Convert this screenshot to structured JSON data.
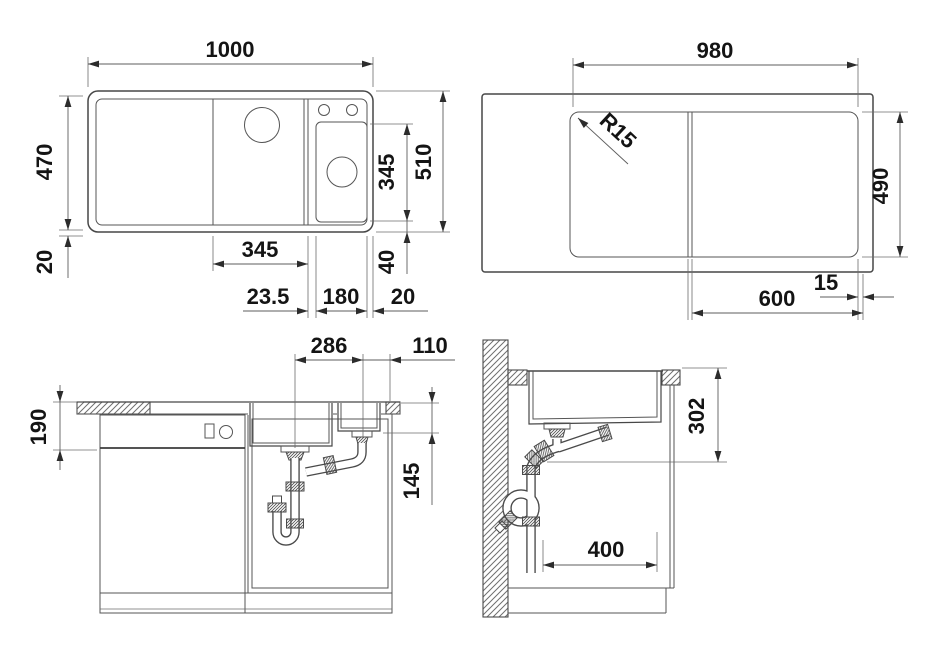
{
  "drawing_type": "sink installation technical drawing",
  "colors": {
    "line": "#4a4a4a",
    "text": "#141414",
    "background": "#ffffff"
  },
  "views": {
    "plan": {
      "title": "plan-view-of-sink",
      "dims": {
        "total_width": "1000",
        "basin_height": "470",
        "bottom_edge": "20",
        "bowl_width": "345",
        "bowl_gap": "23.5",
        "accessory_width": "180",
        "right_edge": "20",
        "accessory_height": "345",
        "total_height": "510",
        "accessory_bottom_gap": "40"
      }
    },
    "cutout": {
      "title": "cutout-plan-view",
      "dims": {
        "width": "980",
        "corner_radius": "R15",
        "height": "490",
        "bowl_span": "600",
        "edge_gap": "15"
      }
    },
    "front_section": {
      "title": "front-section-view",
      "dims": {
        "drain_spacing": "286",
        "drain_to_edge": "110",
        "bowl_depth": "190",
        "accessory_bowl_depth": "145"
      }
    },
    "side_section": {
      "title": "side-section-view",
      "dims": {
        "outlet_height": "302",
        "wall_clearance": "400"
      }
    }
  }
}
